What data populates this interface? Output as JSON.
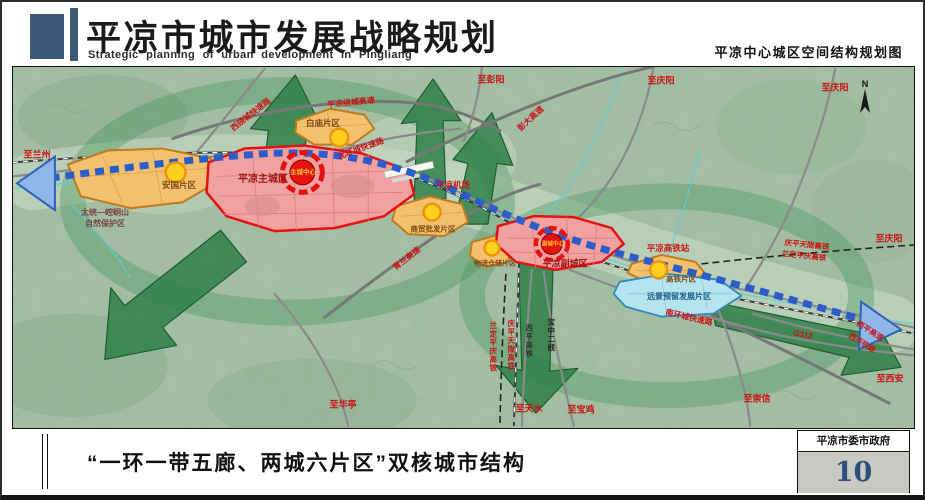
{
  "header": {
    "title": "平凉市城市发展战略规划",
    "subtitle": "Strategic planning of urban development in Pingliang",
    "map_name": "平凉中心城区空间结构规划图"
  },
  "map": {
    "compass_n": "N",
    "labels": {
      "to_lanzhou": "至兰州",
      "to_pengyang": "至彭阳",
      "to_qingyang_a": "至庆阳",
      "to_qingyang_b": "至庆阳",
      "to_qingyang_c": "至庆阳",
      "to_xian": "至西安",
      "to_chongxin": "至崇信",
      "to_huating": "至华亭",
      "to_tianshui": "至天水",
      "to_baoji": "至宝鸡",
      "rd_west_ring": "西绕城快速路",
      "rd_north_ring": "北环城快速路",
      "rd_south_ring": "南环城快速路",
      "rd_pl_ring": "平凉绕城高速",
      "rd_pengda": "彭大高速",
      "rd_qinglan": "青兰高速",
      "rd_g312": "G312",
      "rd_xiping_expwy": "西平高速",
      "rd_xiping_rail": "西平铁路",
      "hsr_qptl": "庆平天陇高铁",
      "hsr_ldpq": "兰定平庆高铁",
      "hsr_xiping": "西平高铁",
      "rail_baozhong2": "宝中二线",
      "airport": "平凉机场",
      "hsr_station": "平凉高铁站",
      "reserve_1": "太统—崆峒山",
      "reserve_2": "自然保护区",
      "zone_anguo": "安国片区",
      "zone_baimiao": "白庙片区",
      "zone_main": "平凉主城区",
      "core_main": "主城中心",
      "zone_sub": "平凉副城区",
      "core_sub": "副城中心",
      "zone_trade": "商贸批发片区",
      "zone_logistics": "物流仓储片区",
      "zone_hsr": "高铁片区",
      "zone_future": "远景预留发展片区"
    }
  },
  "footer": {
    "caption": "“一环一带五廊、两城六片区”双核城市结构",
    "agency": "平凉市委市政府",
    "page_number": "10"
  },
  "colors": {
    "header_block": "#3a5a78",
    "map_base": "#a9c3a8",
    "corridor_green": "#2f8048",
    "belt_blue": "#2c5cc9",
    "red_zone_fill": "#f2a1a1",
    "red_zone_border": "#e31313",
    "orange_zone_fill": "#f2c06e",
    "orange_zone_border": "#c07a1e",
    "future_zone_fill": "#b6e3f0",
    "yellow_node": "#ffce1e",
    "label_red": "#c81414",
    "page_number_blue": "#2d4f78"
  }
}
